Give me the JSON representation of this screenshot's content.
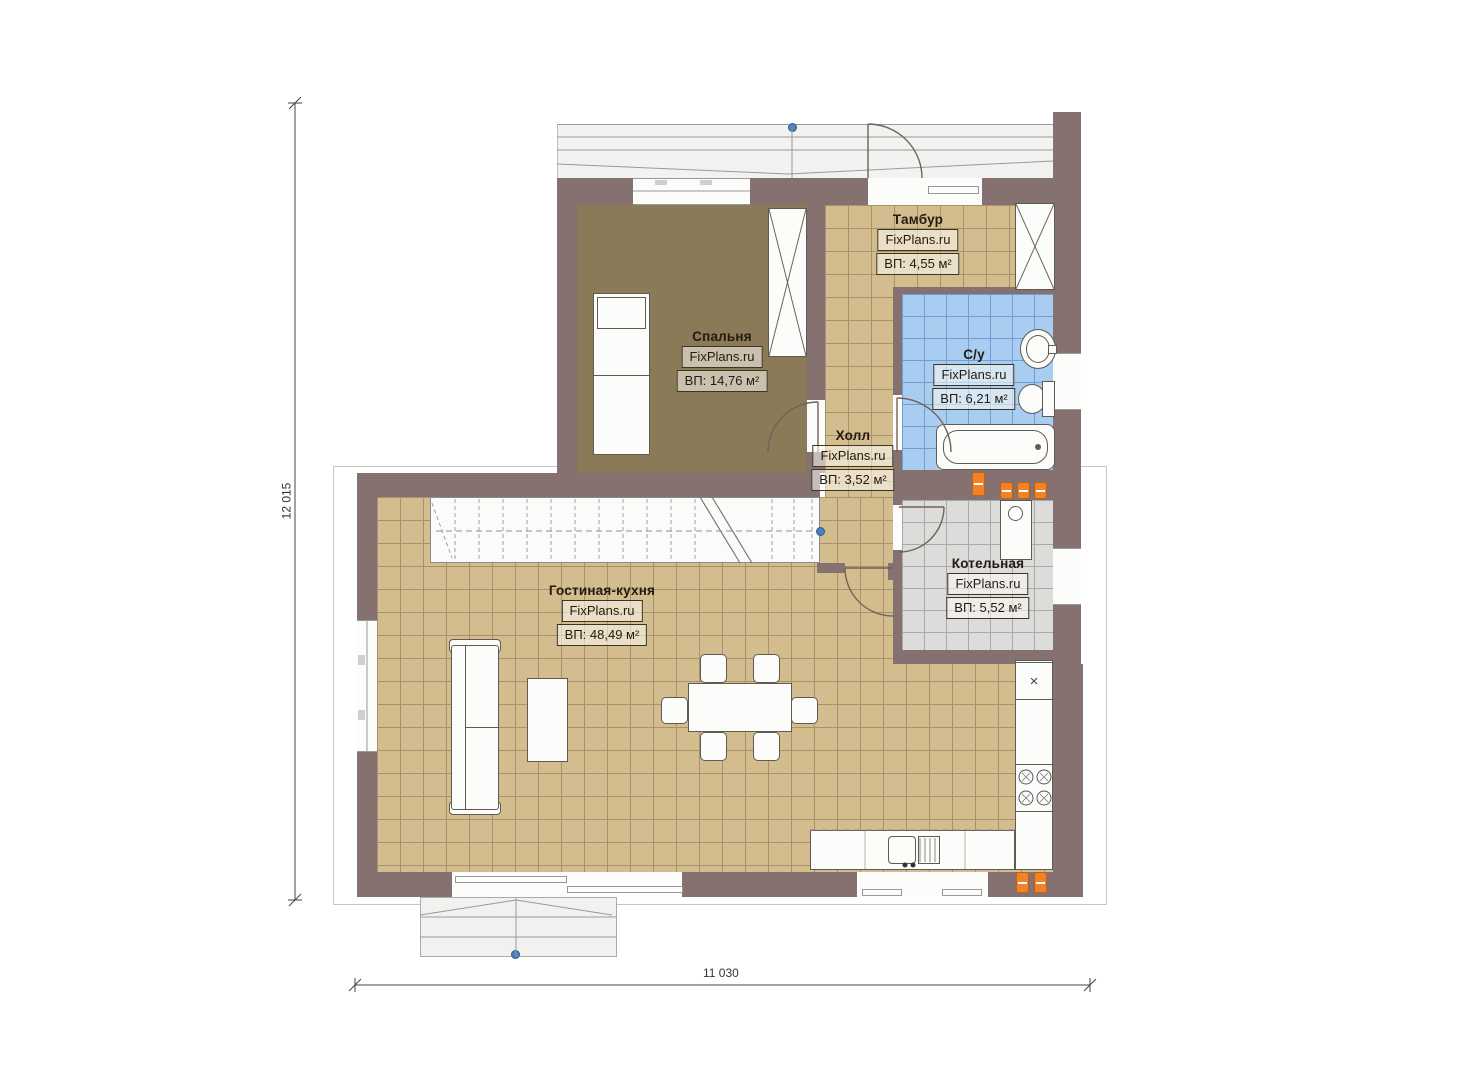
{
  "plan": {
    "brand": "FixPlans.ru",
    "dimensions": {
      "height_label": "12 015",
      "width_label": "11 030"
    },
    "rooms": [
      {
        "name": "Спальня",
        "brand": "FixPlans.ru",
        "area": "ВП: 14,76 м²"
      },
      {
        "name": "Тамбур",
        "brand": "FixPlans.ru",
        "area": "ВП: 4,55 м²"
      },
      {
        "name": "С/у",
        "brand": "FixPlans.ru",
        "area": "ВП: 6,21 м²"
      },
      {
        "name": "Холл",
        "brand": "FixPlans.ru",
        "area": "ВП: 3,52 м²"
      },
      {
        "name": "Котельная",
        "brand": "FixPlans.ru",
        "area": "ВП: 5,52 м²"
      },
      {
        "name": "Гостиная-кухня",
        "brand": "FixPlans.ru",
        "area": "ВП: 48,49 м²"
      }
    ],
    "symbols": {
      "fridge_mark": "×"
    },
    "colors": {
      "wall": "#857170",
      "tile_tan": "#d3bd8e",
      "tile_tan_line": "#a8916b",
      "tile_blue": "#a9cdf0",
      "tile_blue_line": "#6f9fd0",
      "tile_gray": "#dcdcda",
      "carpet": "#8a7a57",
      "radiator": "#f08228",
      "marker": "#4a7fc1"
    }
  }
}
